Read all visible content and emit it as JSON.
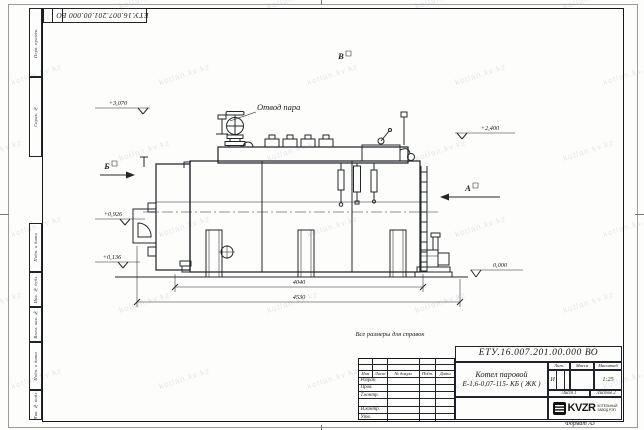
{
  "sheet": {
    "watermark": "kotlan.kv.kz",
    "format_label": "Формат А3",
    "reference_note": "Все размеры для справок",
    "stamp_top": "ЕТУ.16.007.201.00.000  ВО"
  },
  "margins": {
    "top_boxes": [
      {
        "label": "Перв. примен."
      },
      {
        "label": "Справ. №"
      }
    ],
    "bottom_boxes": [
      {
        "label": "Подп. и дата"
      },
      {
        "label": "Инв. № дубл."
      },
      {
        "label": "Взам. инв. №"
      },
      {
        "label": "Подп. и дата"
      },
      {
        "label": "Инв. № подл."
      }
    ]
  },
  "drawing": {
    "callout_steam_outlet": "Отвод пара",
    "view_b": "Б",
    "view_v": "В",
    "view_a": "А",
    "elev_3070": "+3,070",
    "elev_2400": "+2,400",
    "elev_0926": "+0,926",
    "elev_0136": "+0,136",
    "elev_0000": "0,000",
    "dim_4040": "4040",
    "dim_4530": "4530"
  },
  "title_block": {
    "doc_number": "ЕТУ.16.007.201.00.000  ВО",
    "name_line1": "Котел паровой",
    "name_line2": "Е-1,6-0,07-115- КБ ( ЖК )",
    "col_izm": "Изм",
    "col_list": "Лист",
    "col_doc": "№ докум.",
    "col_podp": "Подп.",
    "col_data": "Дата",
    "row_razrab": "Разраб.",
    "row_prov": "Пров.",
    "row_tkontr": "Т.контр.",
    "row_nkontr": "Н.контр.",
    "row_utv": "Утв.",
    "hdr_lit": "Лит.",
    "hdr_massa": "Масса",
    "hdr_scale": "Масштаб",
    "lit_value": "И",
    "scale_value": "1:25",
    "sheet_no": "Лист 1",
    "sheets_total": "Листов 2",
    "org_name": "KVZR",
    "org_line1": "КОТЕЛЬНЫЙ",
    "org_line2": "ЗАВОД РЭП"
  }
}
